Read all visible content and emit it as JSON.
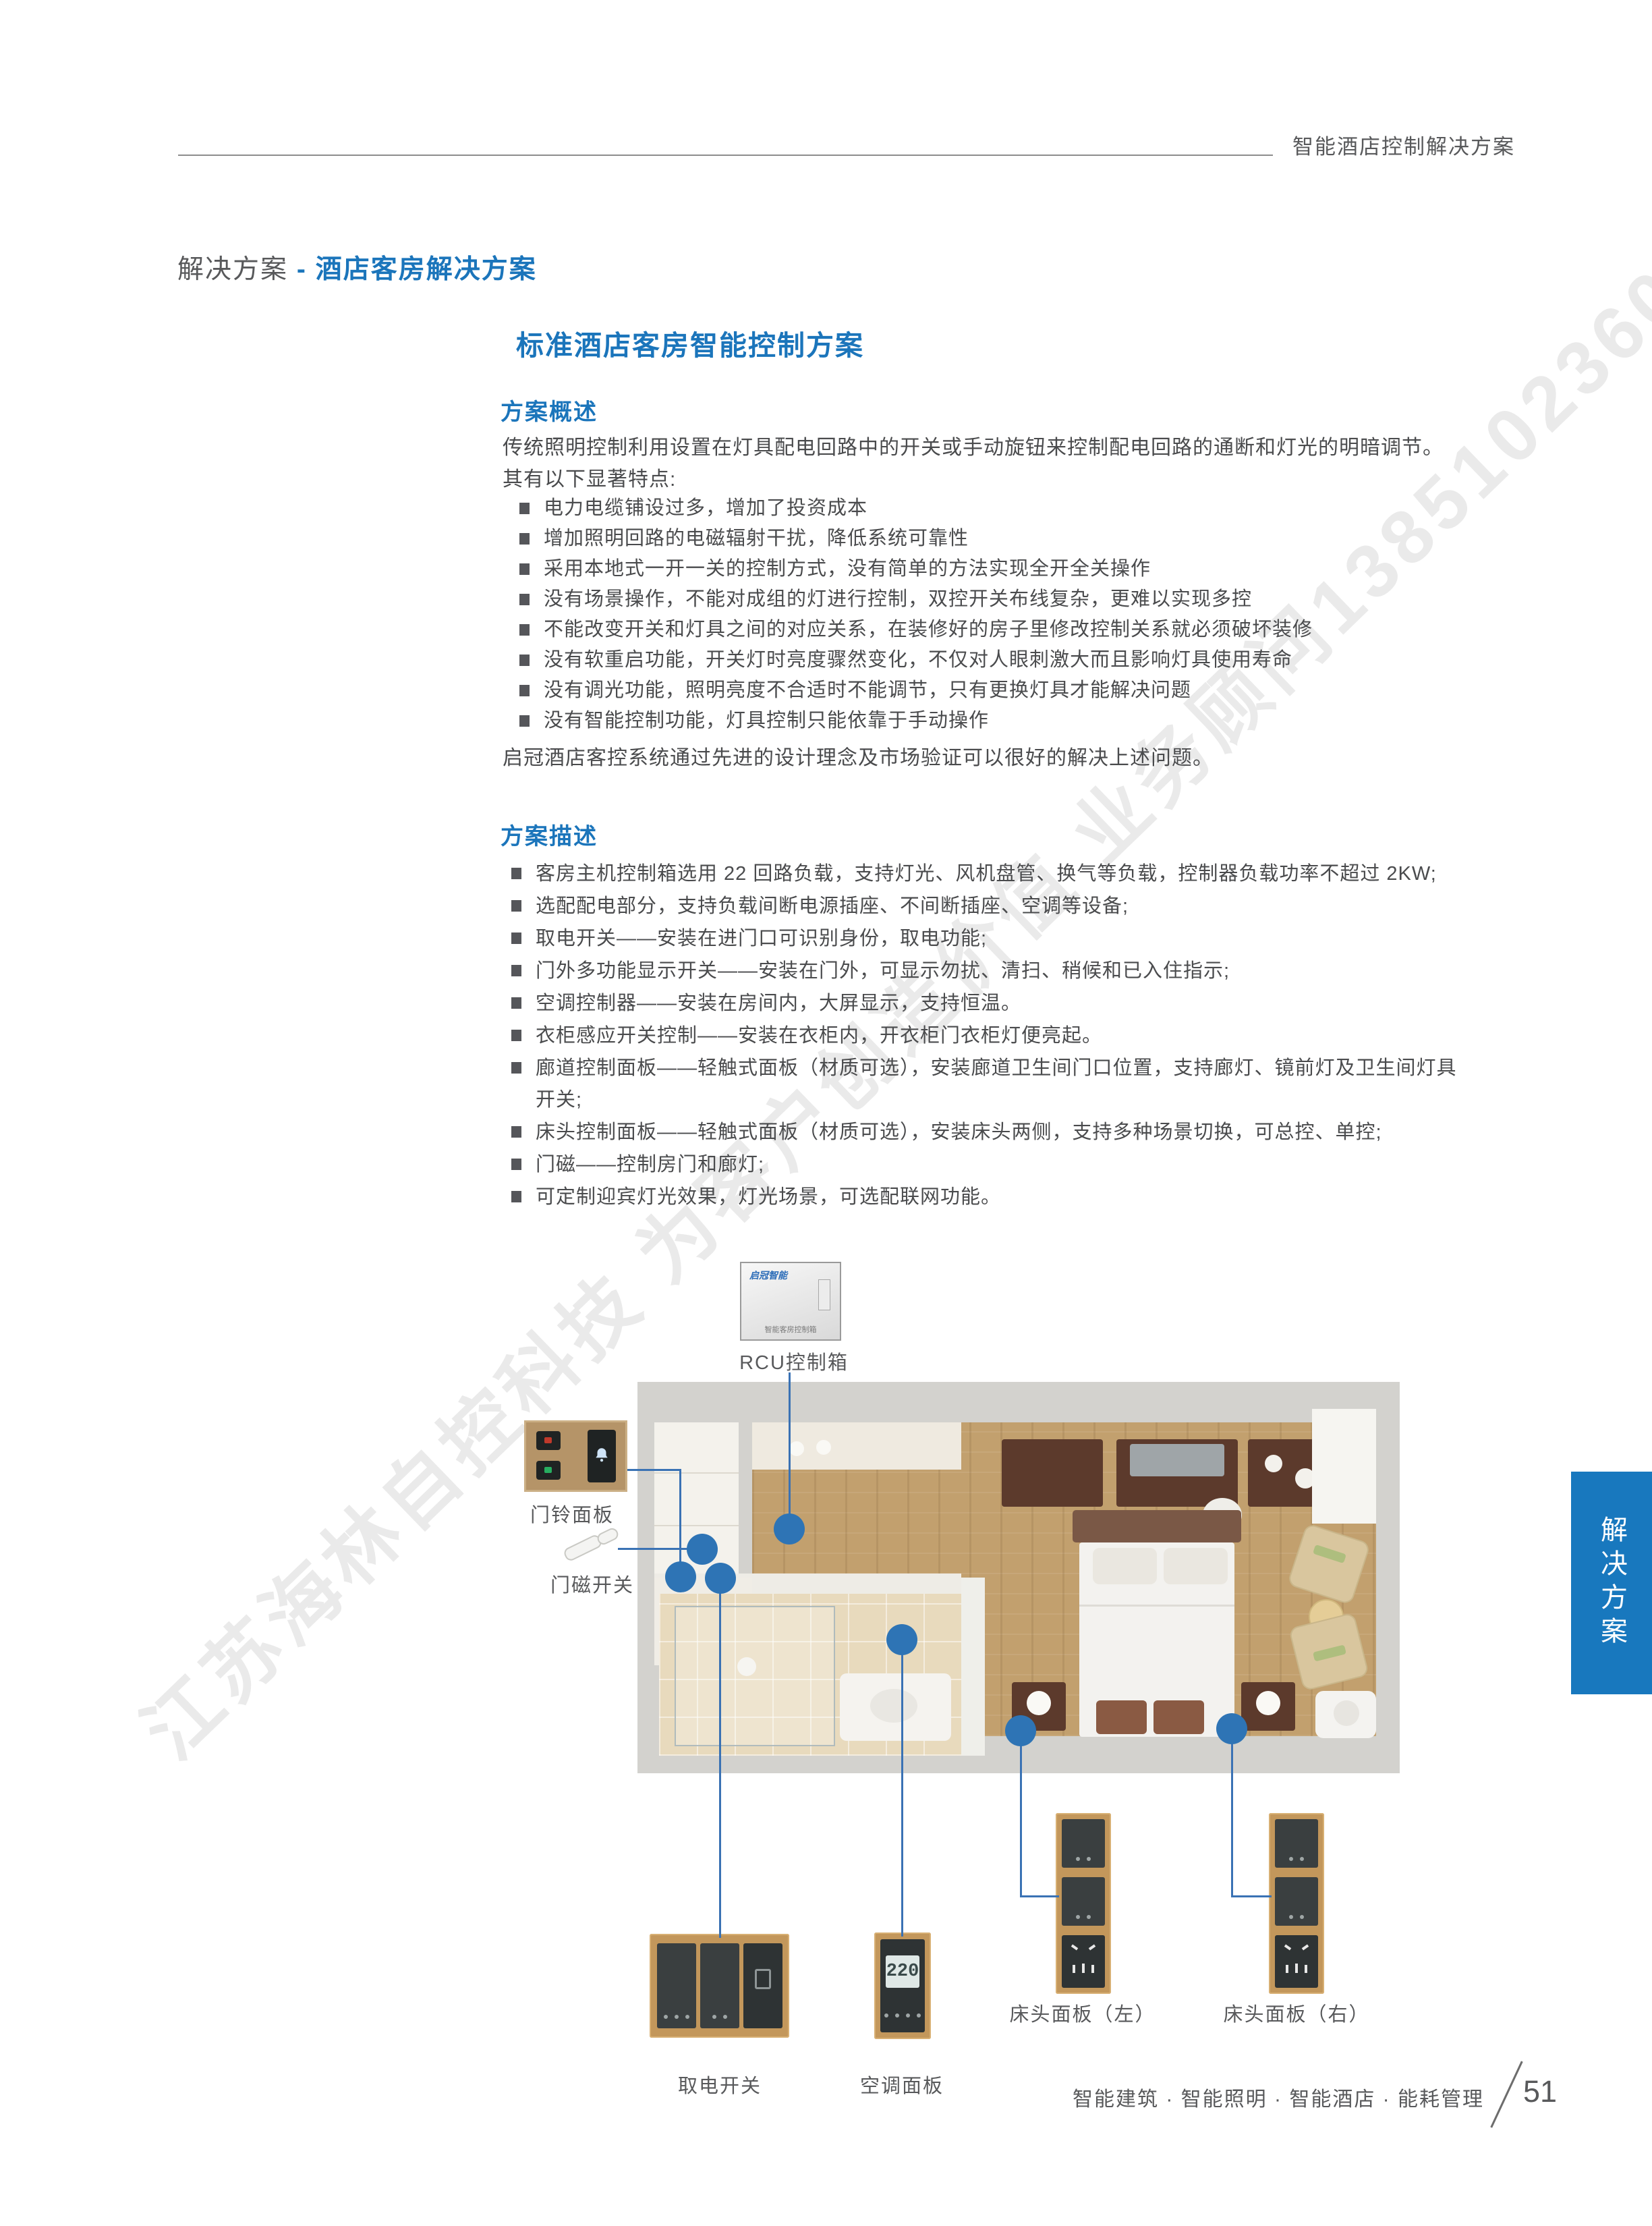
{
  "header": {
    "title": "智能酒店控制解决方案"
  },
  "breadcrumb": {
    "prefix": "解决方案",
    "separator": " - ",
    "current": "酒店客房解决方案"
  },
  "main_title": "标准酒店客房智能控制方案",
  "overview": {
    "heading": "方案概述",
    "intro_1": "传统照明控制利用设置在灯具配电回路中的开关或手动旋钮来控制配电回路的通断和灯光的明暗调节。",
    "intro_2": "其有以下显著特点:",
    "bullets": [
      "电力电缆铺设过多，增加了投资成本",
      "增加照明回路的电磁辐射干扰，降低系统可靠性",
      "采用本地式一开一关的控制方式，没有简单的方法实现全开全关操作",
      "没有场景操作，不能对成组的灯进行控制，双控开关布线复杂，更难以实现多控",
      "不能改变开关和灯具之间的对应关系，在装修好的房子里修改控制关系就必须破坏装修",
      "没有软重启功能，开关灯时亮度骤然变化，不仅对人眼刺激大而且影响灯具使用寿命",
      "没有调光功能，照明亮度不合适时不能调节，只有更换灯具才能解决问题",
      "没有智能控制功能，灯具控制只能依靠于手动操作"
    ],
    "closing": "启冠酒店客控系统通过先进的设计理念及市场验证可以很好的解决上述问题。"
  },
  "description": {
    "heading": "方案描述",
    "bullets": [
      "客房主机控制箱选用 22 回路负载，支持灯光、风机盘管、换气等负载，控制器负载功率不超过 2KW;",
      "选配配电部分，支持负载间断电源插座、不间断插座、空调等设备;",
      "取电开关——安装在进门口可识别身份，取电功能;",
      "门外多功能显示开关——安装在门外，可显示勿扰、清扫、稍候和已入住指示;",
      "空调控制器——安装在房间内，大屏显示，支持恒温。",
      "衣柜感应开关控制——安装在衣柜内，开衣柜门衣柜灯便亮起。",
      "廊道控制面板——轻触式面板（材质可选），安装廊道卫生间门口位置，支持廊灯、镜前灯及卫生间灯具开关;",
      "床头控制面板——轻触式面板（材质可选），安装床头两侧，支持多种场景切换，可总控、单控;",
      "门磁——控制房门和廊灯;",
      "可定制迎宾灯光效果，灯光场景，可选配联网功能。"
    ]
  },
  "diagram": {
    "rcu_logo": "启冠智能",
    "rcu_box_text": "智能客房控制箱",
    "rcu_label": "RCU控制箱",
    "doorbell_label": "门铃面板",
    "door_magnet_label": "门磁开关",
    "power_switch_label": "取电开关",
    "ac_panel_label": "空调面板",
    "ac_lcd_value": "220",
    "bedside_left_label": "床头面板（左）",
    "bedside_right_label": "床头面板（右）"
  },
  "side_tab": {
    "label": "解决方案"
  },
  "footer": {
    "text": "智能建筑 · 智能照明 · 智能酒店 · 能耗管理",
    "page_number": "51"
  },
  "watermark": {
    "text": "江苏海林自控科技 为客户创造价值 业务顾问13851023601"
  },
  "colors": {
    "accent_blue": "#1B75BB",
    "connector_blue": "#3A72B4",
    "panel_gold": "#C3975B",
    "tab_blue": "#1878BE"
  }
}
